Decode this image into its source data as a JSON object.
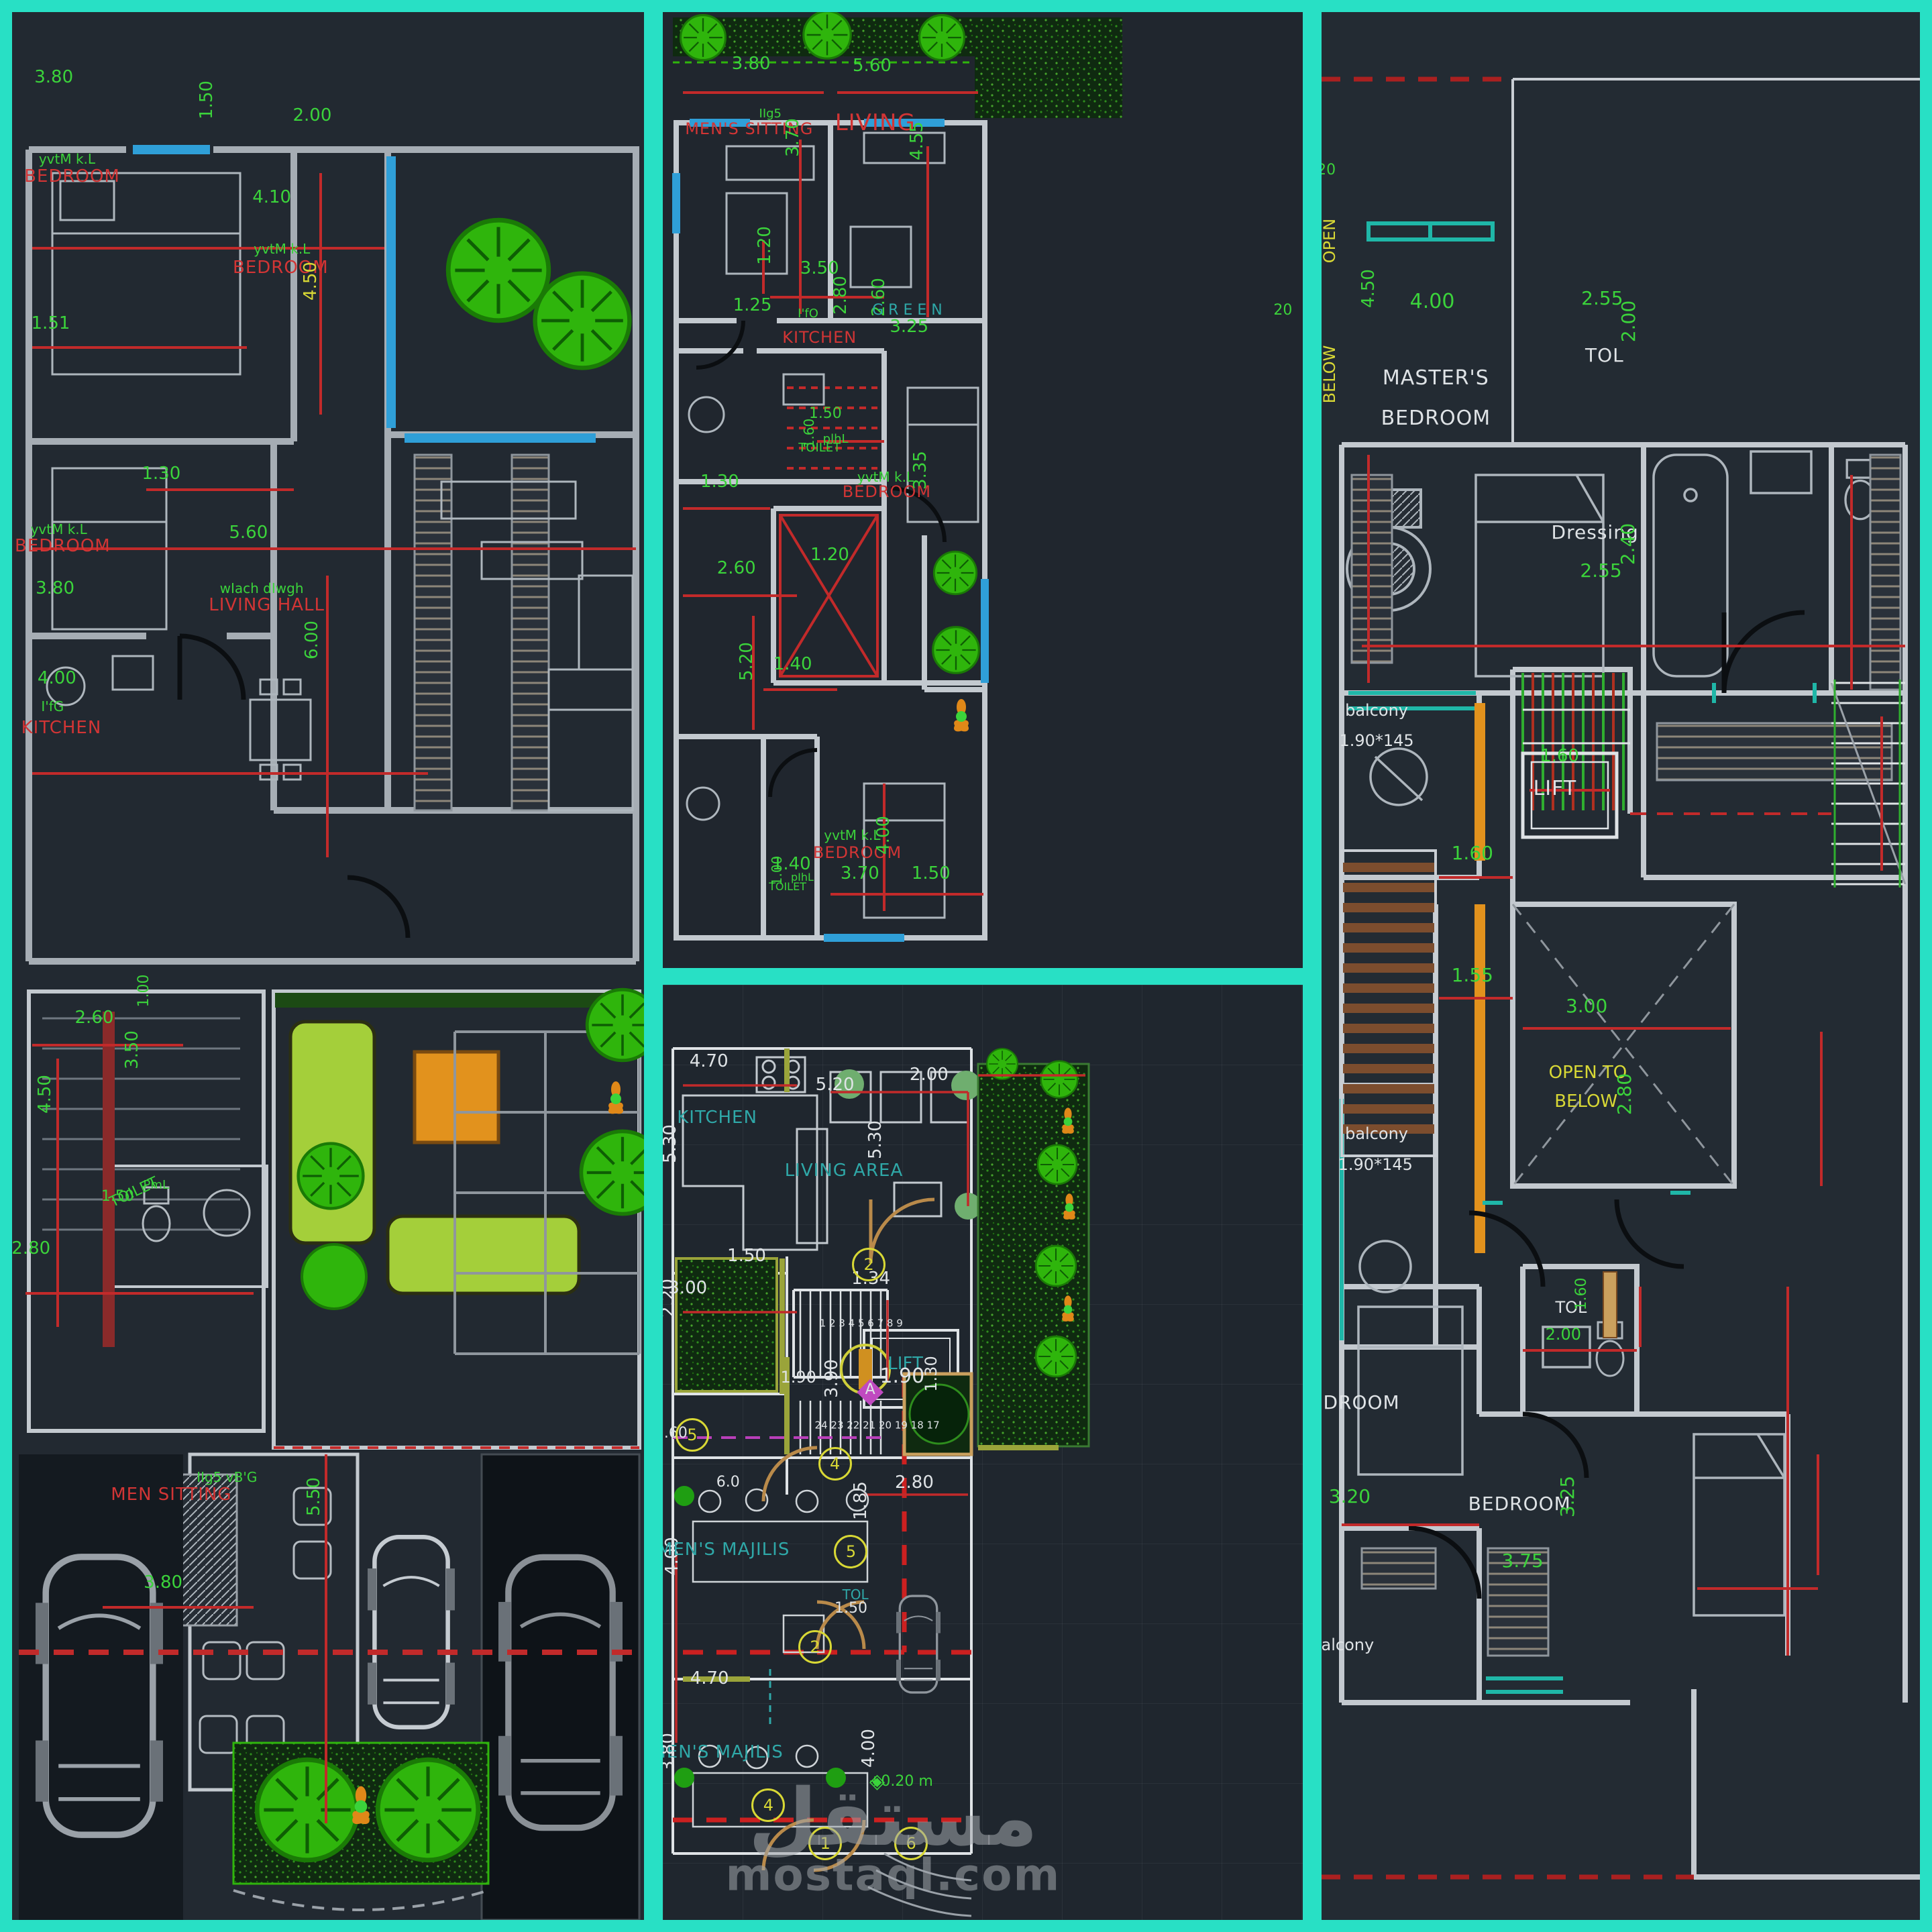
{
  "palette": {
    "green": "#3bd33b",
    "red": "#d23535",
    "white": "#dfe3e6",
    "yellow": "#d8d835",
    "teal": "#2fa8a8",
    "cyan": "#2f9fd8",
    "gray": "#9aa0a6",
    "magenta": "#c04ac0",
    "frame": "#28e0c5",
    "paper": "#222931",
    "dimline": "#c22a2a",
    "wall": "#c3c9cf",
    "tree": "#2fb50c",
    "sofa": "#a4cf3a",
    "orange": "#e2921d"
  },
  "watermark": {
    "arabic": "مستقل",
    "domain": "mostaql.com"
  },
  "panels": [
    {
      "id": "left",
      "name": "floor-plan-left",
      "labels": [
        {
          "t": "3.80",
          "x": 6.6,
          "y": 3.4
        },
        {
          "t": "yvtM k.L",
          "x": 8.7,
          "y": 7.7,
          "s": 20
        },
        {
          "t": "BEDROOM",
          "x": 9.5,
          "y": 8.6,
          "c": "red",
          "cls": "room"
        },
        {
          "t": "1.50",
          "x": 30.8,
          "y": 4.6,
          "r": -90
        },
        {
          "t": "2.00",
          "x": 47.5,
          "y": 5.4
        },
        {
          "t": "4.10",
          "x": 41.1,
          "y": 9.7
        },
        {
          "t": "yvtM k.L",
          "x": 42.7,
          "y": 12.4,
          "s": 20
        },
        {
          "t": "BEDROOM",
          "x": 42.5,
          "y": 13.4,
          "c": "red",
          "cls": "room"
        },
        {
          "t": "4.50",
          "x": 47.2,
          "y": 14.1,
          "r": -90,
          "c": "yellow"
        },
        {
          "t": "1.51",
          "x": 6.1,
          "y": 16.3
        },
        {
          "t": "1.30",
          "x": 23.6,
          "y": 24.2
        },
        {
          "t": "yvtM k.L",
          "x": 7.4,
          "y": 27.1,
          "s": 20
        },
        {
          "t": "BEDROOM",
          "x": 8.0,
          "y": 28.0,
          "c": "red",
          "cls": "room"
        },
        {
          "t": "3.80",
          "x": 6.8,
          "y": 30.2
        },
        {
          "t": "5.60",
          "x": 37.4,
          "y": 27.3
        },
        {
          "t": "wIach dIwgh",
          "x": 39.5,
          "y": 30.2,
          "s": 20
        },
        {
          "t": "LIVING HALL",
          "x": 40.3,
          "y": 31.1,
          "c": "red",
          "cls": "room"
        },
        {
          "t": "6.00",
          "x": 47.5,
          "y": 32.9,
          "r": -90
        },
        {
          "t": "4.00",
          "x": 7.1,
          "y": 34.9
        },
        {
          "t": "I'fG",
          "x": 6.4,
          "y": 36.4,
          "s": 20
        },
        {
          "t": "KITCHEN",
          "x": 7.8,
          "y": 37.5,
          "c": "red",
          "cls": "room"
        },
        {
          "t": "2.60",
          "x": 13.0,
          "y": 52.7
        },
        {
          "t": "1.00",
          "x": 20.9,
          "y": 51.3,
          "r": -90,
          "s": 22
        },
        {
          "t": "3.50",
          "x": 19.0,
          "y": 54.4,
          "r": -90
        },
        {
          "t": "4.50",
          "x": 5.2,
          "y": 56.7,
          "r": -90
        },
        {
          "t": "TOILET",
          "x": 19.3,
          "y": 61.9,
          "r": -25,
          "s": 22
        },
        {
          "t": "PmL",
          "x": 22.8,
          "y": 61.5,
          "s": 18
        },
        {
          "t": "1.50",
          "x": 16.7,
          "y": 62.1,
          "s": 22
        },
        {
          "t": "2.80",
          "x": 3.0,
          "y": 64.8
        },
        {
          "t": "MEN SITTING",
          "x": 25.2,
          "y": 77.7,
          "c": "red",
          "cls": "room"
        },
        {
          "t": "IIg5 vB'G",
          "x": 34.0,
          "y": 76.8,
          "s": 20
        },
        {
          "t": "5.50",
          "x": 47.8,
          "y": 77.8,
          "r": -90
        },
        {
          "t": "3.80",
          "x": 23.9,
          "y": 82.3
        }
      ]
    },
    {
      "id": "mt",
      "name": "floor-plan-middle-top",
      "labels": [
        {
          "t": "3.80",
          "x": 13.8,
          "y": 5.4
        },
        {
          "t": "5.60",
          "x": 32.7,
          "y": 5.6
        },
        {
          "t": "IIg5",
          "x": 16.8,
          "y": 10.7,
          "s": 18
        },
        {
          "t": "MEN'S SITTING",
          "x": 13.5,
          "y": 12.2,
          "c": "red",
          "cls": "room",
          "s": 24
        },
        {
          "t": "3.70",
          "x": 20.3,
          "y": 13.1,
          "r": -90
        },
        {
          "t": "LIVING",
          "x": 33.2,
          "y": 11.6,
          "c": "red",
          "cls": "room",
          "s": 34
        },
        {
          "t": "4.55",
          "x": 39.7,
          "y": 13.5,
          "r": -90
        },
        {
          "t": "1.20",
          "x": 15.9,
          "y": 24.4,
          "r": -90
        },
        {
          "t": "3.50",
          "x": 24.5,
          "y": 26.8
        },
        {
          "t": "1.25",
          "x": 14.0,
          "y": 30.7
        },
        {
          "t": "2.80",
          "x": 27.8,
          "y": 29.6,
          "r": -90
        },
        {
          "t": "I'fO",
          "x": 22.7,
          "y": 31.6,
          "s": 18
        },
        {
          "t": "KITCHEN",
          "x": 24.5,
          "y": 34.0,
          "c": "red",
          "cls": "room",
          "s": 24
        },
        {
          "t": "2.60",
          "x": 33.8,
          "y": 29.8,
          "r": -90
        },
        {
          "t": "G R E E N",
          "x": 38.2,
          "y": 31.2,
          "c": "teal",
          "s": 22
        },
        {
          "t": "3.25",
          "x": 38.5,
          "y": 32.9
        },
        {
          "t": "20",
          "x": 96.9,
          "y": 31.2,
          "s": 22
        },
        {
          "t": "1.50",
          "x": 25.4,
          "y": 42.0,
          "s": 22
        },
        {
          "t": "1.60",
          "x": 22.9,
          "y": 44.1,
          "r": -90,
          "s": 20
        },
        {
          "t": "plhL",
          "x": 27.0,
          "y": 44.7,
          "s": 18
        },
        {
          "t": "TOILET",
          "x": 24.5,
          "y": 45.6,
          "s": 18
        },
        {
          "t": "yvtM k.L",
          "x": 34.8,
          "y": 48.6,
          "s": 20
        },
        {
          "t": "BEDROOM",
          "x": 35.0,
          "y": 50.2,
          "c": "red",
          "cls": "room",
          "s": 24
        },
        {
          "t": "3.35",
          "x": 40.3,
          "y": 47.9,
          "r": -90
        },
        {
          "t": "1.30",
          "x": 8.9,
          "y": 49.1
        },
        {
          "t": "1.20",
          "x": 26.1,
          "y": 56.8
        },
        {
          "t": "2.60",
          "x": 11.5,
          "y": 58.2
        },
        {
          "t": "5.20",
          "x": 13.1,
          "y": 67.9,
          "r": -90
        },
        {
          "t": "1.40",
          "x": 20.3,
          "y": 68.2
        },
        {
          "t": "1.40",
          "x": 20.1,
          "y": 89.1
        },
        {
          "t": "1.00",
          "x": 17.8,
          "y": 89.8,
          "r": -90,
          "s": 20
        },
        {
          "t": "pIhL",
          "x": 21.8,
          "y": 90.5,
          "s": 16
        },
        {
          "t": "TOILET",
          "x": 19.5,
          "y": 91.5,
          "s": 16
        },
        {
          "t": "yvtM k.L",
          "x": 29.6,
          "y": 86.1,
          "s": 20
        },
        {
          "t": "BEDROOM",
          "x": 30.4,
          "y": 87.9,
          "c": "red",
          "cls": "room",
          "s": 24
        },
        {
          "t": "4.00",
          "x": 34.5,
          "y": 86.1,
          "r": -90
        },
        {
          "t": "3.70",
          "x": 30.8,
          "y": 90.1
        },
        {
          "t": "1.50",
          "x": 41.9,
          "y": 90.1
        }
      ]
    },
    {
      "id": "mb",
      "name": "floor-plan-middle-bottom",
      "labels": [
        {
          "t": "4.70",
          "x": 7.2,
          "y": 8.2,
          "c": "white"
        },
        {
          "t": "KITCHEN",
          "x": 8.5,
          "y": 14.2,
          "c": "teal",
          "cls": "room"
        },
        {
          "t": "5.30",
          "x": 1.2,
          "y": 17.0,
          "r": -90,
          "c": "white"
        },
        {
          "t": "5.20",
          "x": 26.9,
          "y": 10.7,
          "c": "white"
        },
        {
          "t": "2.00",
          "x": 41.6,
          "y": 9.6,
          "c": "white"
        },
        {
          "t": "LIVING AREA",
          "x": 28.3,
          "y": 19.9,
          "c": "teal",
          "cls": "room"
        },
        {
          "t": "5.30",
          "x": 33.2,
          "y": 16.6,
          "r": -90,
          "c": "white"
        },
        {
          "t": "1.50",
          "x": 13.1,
          "y": 29.0,
          "c": "white"
        },
        {
          "t": "3.00",
          "x": 3.9,
          "y": 32.4,
          "c": "white"
        },
        {
          "t": "2.20",
          "x": 0.8,
          "y": 33.5,
          "r": -90,
          "c": "white"
        },
        {
          "t": "1.34",
          "x": 32.5,
          "y": 31.4,
          "c": "white"
        },
        {
          "t": "2",
          "x": 32.2,
          "y": 29.9,
          "c": "yellow",
          "cls": "tag",
          "n": "door-tag"
        },
        {
          "t": "1 2 3 4 5 6 7 8 9",
          "x": 31.0,
          "y": 36.2,
          "c": "white",
          "s": 15,
          "n": "stair-numbers"
        },
        {
          "t": "LIFT",
          "x": 37.9,
          "y": 40.5,
          "c": "teal"
        },
        {
          "t": "1.90",
          "x": 37.4,
          "y": 41.9,
          "c": "white",
          "s": 30
        },
        {
          "t": "1.30",
          "x": 41.9,
          "y": 41.6,
          "r": -90,
          "c": "white",
          "s": 24
        },
        {
          "t": "1.90",
          "x": 21.2,
          "y": 42.0,
          "c": "white",
          "s": 24
        },
        {
          "t": "3.90",
          "x": 26.4,
          "y": 42.1,
          "r": -90,
          "c": "white"
        },
        {
          "t": "24 23 22 21 20 19 18 17",
          "x": 33.5,
          "y": 47.1,
          "c": "white",
          "s": 15,
          "n": "stair-numbers"
        },
        {
          "t": "◆",
          "x": 32.4,
          "y": 43.3,
          "c": "magenta",
          "s": 52,
          "n": "section-marker-icon"
        },
        {
          "t": "A",
          "x": 32.4,
          "y": 43.3,
          "c": "white",
          "s": 22,
          "n": "section-marker"
        },
        {
          "t": "1.60",
          "x": 1.3,
          "y": 48.0,
          "c": "white",
          "s": 22
        },
        {
          "t": "5",
          "x": 4.6,
          "y": 48.1,
          "c": "yellow",
          "cls": "tag",
          "n": "door-tag"
        },
        {
          "t": "4",
          "x": 26.9,
          "y": 51.2,
          "c": "yellow",
          "cls": "tag",
          "n": "door-tag"
        },
        {
          "t": "6.0",
          "x": 10.2,
          "y": 53.2,
          "c": "white",
          "s": 22
        },
        {
          "t": "2.80",
          "x": 39.3,
          "y": 53.2,
          "c": "white"
        },
        {
          "t": "1.85",
          "x": 30.9,
          "y": 55.2,
          "r": -90,
          "c": "white"
        },
        {
          "t": "4.00",
          "x": 1.5,
          "y": 61.1,
          "r": -90,
          "c": "white"
        },
        {
          "t": "MEN'S MAJILIS",
          "x": 9.5,
          "y": 60.4,
          "c": "teal",
          "cls": "room"
        },
        {
          "t": "5",
          "x": 29.4,
          "y": 60.6,
          "c": "yellow",
          "cls": "tag",
          "n": "door-tag"
        },
        {
          "t": "TOL",
          "x": 30.1,
          "y": 65.2,
          "c": "teal",
          "s": 20
        },
        {
          "t": "1.50",
          "x": 29.4,
          "y": 66.7,
          "c": "white",
          "s": 22
        },
        {
          "t": "2",
          "x": 23.8,
          "y": 70.8,
          "c": "yellow",
          "cls": "tag",
          "n": "door-tag"
        },
        {
          "t": "4.70",
          "x": 7.3,
          "y": 74.2,
          "c": "white"
        },
        {
          "t": "MEN'S MAJILIS",
          "x": 8.5,
          "y": 82.1,
          "c": "teal",
          "cls": "room"
        },
        {
          "t": "3.80",
          "x": 0.8,
          "y": 82.1,
          "r": -90,
          "c": "white"
        },
        {
          "t": "4",
          "x": 16.5,
          "y": 87.7,
          "c": "yellow",
          "cls": "tag",
          "n": "door-tag"
        },
        {
          "t": "1",
          "x": 25.4,
          "y": 91.8,
          "c": "yellow",
          "cls": "tag",
          "n": "door-tag"
        },
        {
          "t": "6",
          "x": 38.8,
          "y": 91.8,
          "c": "yellow",
          "cls": "tag",
          "n": "door-tag"
        },
        {
          "t": "4.00",
          "x": 32.2,
          "y": 81.6,
          "r": -90,
          "c": "white"
        },
        {
          "t": "◈",
          "x": 33.5,
          "y": 85.2,
          "c": "green",
          "s": 30,
          "n": "level-marker-icon"
        },
        {
          "t": "+0.20 m",
          "x": 37.2,
          "y": 85.2,
          "c": "green",
          "s": 22,
          "n": "level-label"
        }
      ]
    },
    {
      "id": "right",
      "name": "floor-plan-right",
      "labels": [
        {
          "t": "20",
          "x": 0.8,
          "y": 8.3,
          "s": 22
        },
        {
          "t": "OPEN",
          "x": 1.3,
          "y": 12.0,
          "r": -90,
          "c": "yellow",
          "s": 24
        },
        {
          "t": "BELOW",
          "x": 1.3,
          "y": 19.0,
          "r": -90,
          "c": "yellow",
          "s": 24
        },
        {
          "t": "4.50",
          "x": 7.8,
          "y": 14.5,
          "r": -90
        },
        {
          "t": "4.00",
          "x": 18.5,
          "y": 15.2,
          "s": 30
        },
        {
          "t": "MASTER'S",
          "x": 19.1,
          "y": 19.2,
          "c": "white",
          "cls": "room",
          "s": 30
        },
        {
          "t": "BEDROOM",
          "x": 19.1,
          "y": 21.3,
          "c": "white",
          "cls": "room",
          "s": 30
        },
        {
          "t": "2.55",
          "x": 46.9,
          "y": 15.0,
          "s": 28
        },
        {
          "t": "2.00",
          "x": 51.3,
          "y": 16.2,
          "r": -90,
          "s": 28
        },
        {
          "t": "TOL",
          "x": 47.3,
          "y": 18.0,
          "c": "white",
          "cls": "room",
          "s": 28
        },
        {
          "t": "Dressing",
          "x": 45.7,
          "y": 27.3,
          "c": "white",
          "cls": "room",
          "s": 28
        },
        {
          "t": "2.55",
          "x": 46.7,
          "y": 29.3,
          "s": 28
        },
        {
          "t": "2.40",
          "x": 51.2,
          "y": 27.9,
          "r": -90,
          "s": 28
        },
        {
          "t": "balcony",
          "x": 9.2,
          "y": 36.6,
          "c": "white",
          "s": 24
        },
        {
          "t": "1.90*145",
          "x": 9.2,
          "y": 38.2,
          "c": "white",
          "s": 24
        },
        {
          "t": "1.60",
          "x": 39.8,
          "y": 39.0
        },
        {
          "t": "LIFT",
          "x": 39.0,
          "y": 40.7,
          "c": "white",
          "cls": "room",
          "s": 30
        },
        {
          "t": "1.60",
          "x": 25.2,
          "y": 44.1,
          "s": 28
        },
        {
          "t": "1.55",
          "x": 25.2,
          "y": 50.5,
          "s": 28
        },
        {
          "t": "3.00",
          "x": 44.3,
          "y": 52.1,
          "s": 28
        },
        {
          "t": "OPEN TO",
          "x": 44.5,
          "y": 55.6,
          "c": "yellow",
          "s": 26
        },
        {
          "t": "BELOW",
          "x": 44.2,
          "y": 57.1,
          "c": "yellow",
          "s": 26
        },
        {
          "t": "2.80",
          "x": 50.7,
          "y": 56.7,
          "r": -90,
          "s": 28
        },
        {
          "t": "balcony",
          "x": 9.2,
          "y": 58.8,
          "c": "white",
          "s": 24
        },
        {
          "t": "1.90*145",
          "x": 9.0,
          "y": 60.4,
          "c": "white",
          "s": 24
        },
        {
          "t": "BEDROOM",
          "x": 4.5,
          "y": 72.9,
          "c": "white",
          "cls": "room",
          "s": 28
        },
        {
          "t": "TOL",
          "x": 41.7,
          "y": 67.9,
          "c": "white",
          "s": 24
        },
        {
          "t": "1.60",
          "x": 43.5,
          "y": 67.2,
          "r": -90,
          "s": 22
        },
        {
          "t": "2.00",
          "x": 40.4,
          "y": 69.3,
          "s": 24
        },
        {
          "t": "3.20",
          "x": 4.7,
          "y": 77.8,
          "s": 28
        },
        {
          "t": "BEDROOM",
          "x": 33.1,
          "y": 78.2,
          "c": "white",
          "cls": "room",
          "s": 28
        },
        {
          "t": "3.25",
          "x": 41.1,
          "y": 77.8,
          "r": -90,
          "s": 28
        },
        {
          "t": "3.75",
          "x": 33.6,
          "y": 81.2,
          "s": 28
        },
        {
          "t": "balcony",
          "x": 3.5,
          "y": 85.6,
          "c": "white",
          "s": 24
        }
      ]
    }
  ]
}
